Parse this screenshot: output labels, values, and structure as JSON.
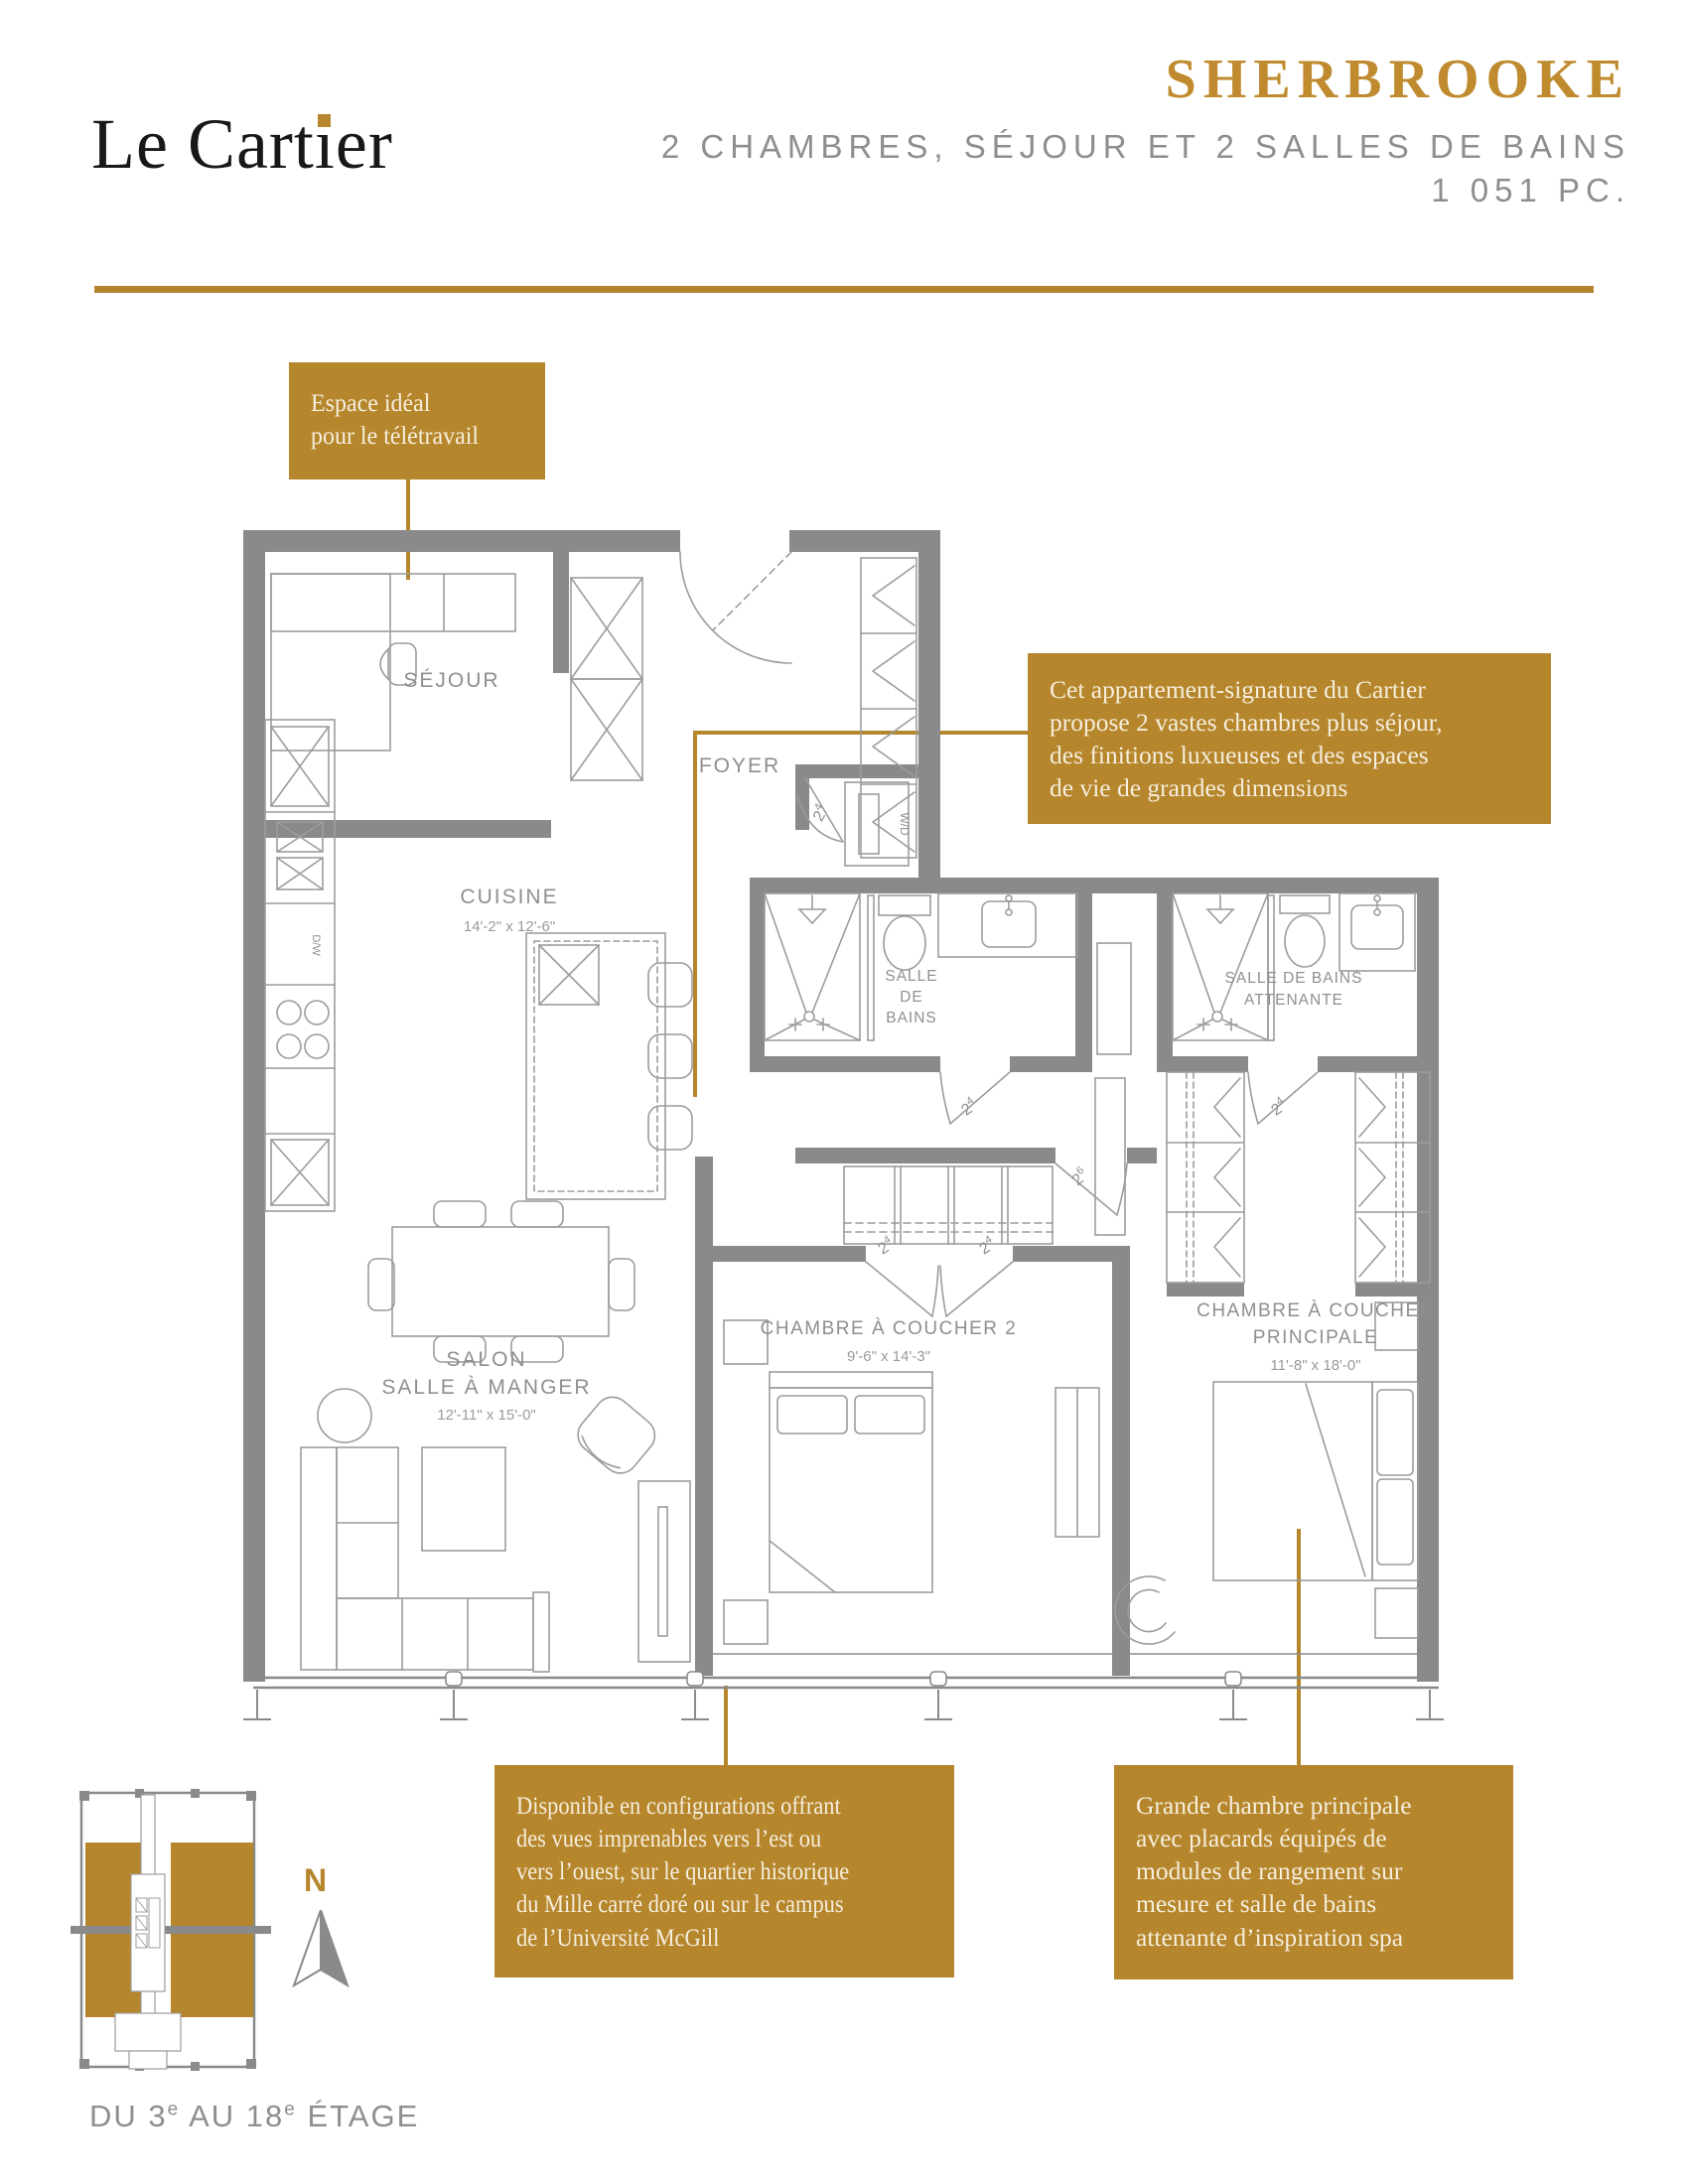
{
  "header": {
    "logo": {
      "part1": "Le Cart",
      "part2": "ı",
      "part3": "er",
      "full_name": "Le Cartier"
    },
    "unit_name": "SHERBROOKE",
    "subtitle_line1": "2 CHAMBRES, SÉJOUR ET 2 SALLES DE BAINS",
    "subtitle_line2": "1 051 PC."
  },
  "callouts": {
    "teletravail": [
      "Espace idéal",
      "pour le télétravail"
    ],
    "signature": [
      "Cet appartement-signature du Cartier",
      "propose 2 vastes chambres plus séjour,",
      "des finitions luxueuses et des espaces",
      "de vie de grandes dimensions"
    ],
    "vues": [
      "Disponible en configurations offrant",
      "des vues imprenables vers l’est ou",
      "vers l’ouest, sur le quartier historique",
      "du Mille carré doré ou sur le campus",
      "de l’Université McGill"
    ],
    "chambre": [
      "Grande chambre principale",
      "avec placards équipés de",
      "modules de rangement sur",
      "mesure et salle de bains",
      "attenante d’inspiration spa"
    ]
  },
  "plan": {
    "rooms": {
      "sejour": "SÉJOUR",
      "foyer": "FOYER",
      "cuisine": "CUISINE",
      "cuisine_dims": "14'-2\" x 12'-6\"",
      "bains_l1": "SALLE",
      "bains_l2": "DE",
      "bains_l3": "BAINS",
      "ensuite_l1": "SALLE DE BAINS",
      "ensuite_l2": "ATTENANTE",
      "chambre2": "CHAMBRE À COUCHER 2",
      "chambre2_dims": "9'-6\" x 14'-3\"",
      "principale_l1": "CHAMBRE À COUCHER",
      "principale_l2": "PRINCIPALE",
      "principale_dims": "11'-8\" x 18'-0\"",
      "salon_l1": "SALON",
      "salon_l2": "SALLE À MANGER",
      "salon_dims": "12'-11\" x 15'-0\"",
      "wd": "W/D",
      "dw": "D/W"
    },
    "door_labels": {
      "num": "2",
      "s4": "4",
      "s6": "6"
    }
  },
  "keyplan": {
    "caption": {
      "p1": "DU 3",
      "sup1": "e",
      "p2": " AU 18",
      "sup2": "e",
      "p3": " ÉTAGE"
    },
    "north": "N"
  },
  "colors": {
    "gold": "#b5862c",
    "title_gold": "#bf8b2e",
    "rule_gold": "#b5832b",
    "wall_gray": "#8a8a8a",
    "furniture_line_gray": "#9c9c9c",
    "label_gray": "#8f8f8f",
    "subtitle_gray": "#8e8e8e",
    "callout_text_cream": "#f6eedd",
    "logo_black": "#181818"
  }
}
